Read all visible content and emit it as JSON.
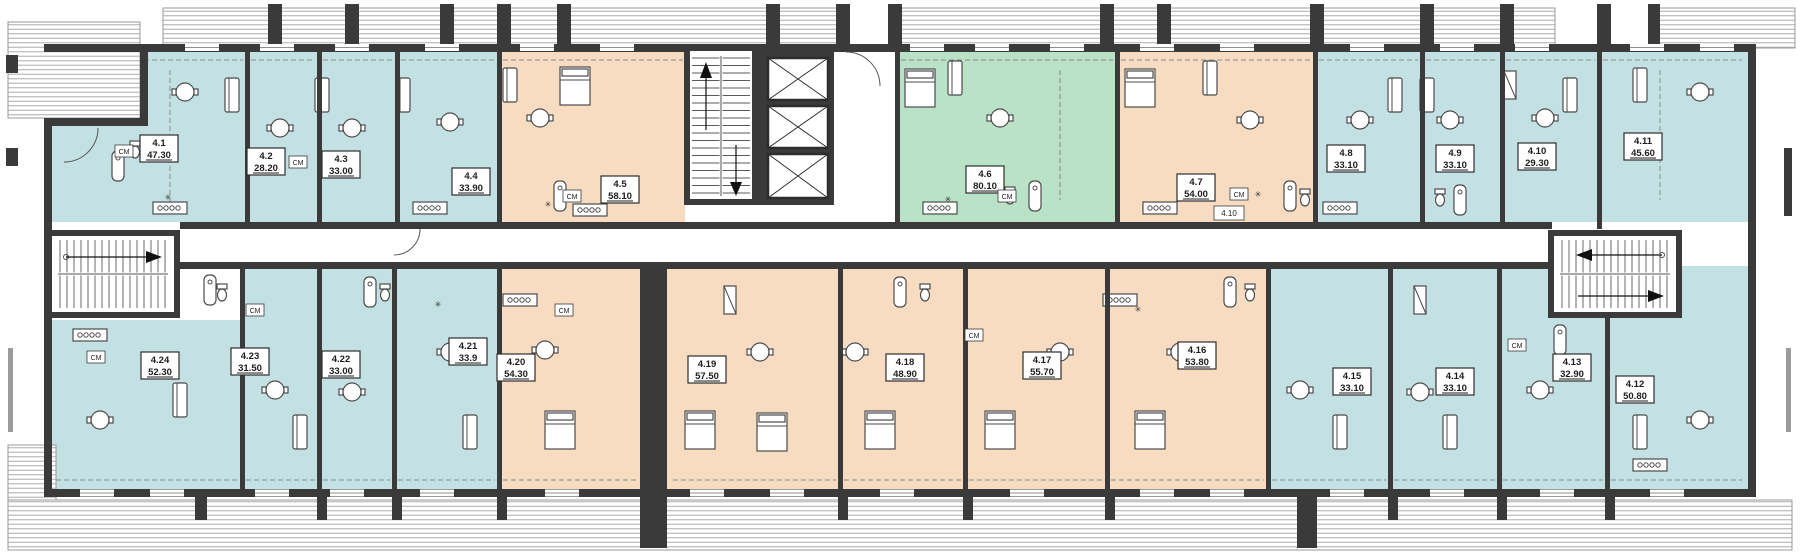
{
  "plan_type": "apartment-building-floor-plan",
  "colors": {
    "teal": "#c3e1e3",
    "peach": "#f8dcc2",
    "green": "#b9e2c6",
    "wall": "#3a3a3a"
  },
  "tags": {
    "cm": "СМ",
    "star": "✳"
  },
  "storage_label": {
    "id": "4.10"
  },
  "apartments": [
    {
      "id": "4.1",
      "area": "47.30",
      "color": "teal"
    },
    {
      "id": "4.2",
      "area": "28.20",
      "color": "teal"
    },
    {
      "id": "4.3",
      "area": "33.00",
      "color": "teal"
    },
    {
      "id": "4.4",
      "area": "33.90",
      "color": "teal"
    },
    {
      "id": "4.5",
      "area": "58.10",
      "color": "peach"
    },
    {
      "id": "4.6",
      "area": "80.10",
      "color": "green"
    },
    {
      "id": "4.7",
      "area": "54.00",
      "color": "peach"
    },
    {
      "id": "4.8",
      "area": "33.10",
      "color": "teal"
    },
    {
      "id": "4.9",
      "area": "33.10",
      "color": "teal"
    },
    {
      "id": "4.10",
      "area": "29.30",
      "color": "teal"
    },
    {
      "id": "4.11",
      "area": "45.60",
      "color": "teal"
    },
    {
      "id": "4.12",
      "area": "50.80",
      "color": "teal"
    },
    {
      "id": "4.13",
      "area": "32.90",
      "color": "teal"
    },
    {
      "id": "4.14",
      "area": "33.10",
      "color": "teal"
    },
    {
      "id": "4.15",
      "area": "33.10",
      "color": "teal"
    },
    {
      "id": "4.16",
      "area": "53.80",
      "color": "peach"
    },
    {
      "id": "4.17",
      "area": "55.70",
      "color": "peach"
    },
    {
      "id": "4.18",
      "area": "48.90",
      "color": "peach"
    },
    {
      "id": "4.19",
      "area": "57.50",
      "color": "peach"
    },
    {
      "id": "4.20",
      "area": "54.30",
      "color": "peach"
    },
    {
      "id": "4.21",
      "area": "33.9",
      "color": "teal"
    },
    {
      "id": "4.22",
      "area": "33.00",
      "color": "teal"
    },
    {
      "id": "4.23",
      "area": "31.50",
      "color": "teal"
    },
    {
      "id": "4.24",
      "area": "52.30",
      "color": "teal"
    }
  ]
}
